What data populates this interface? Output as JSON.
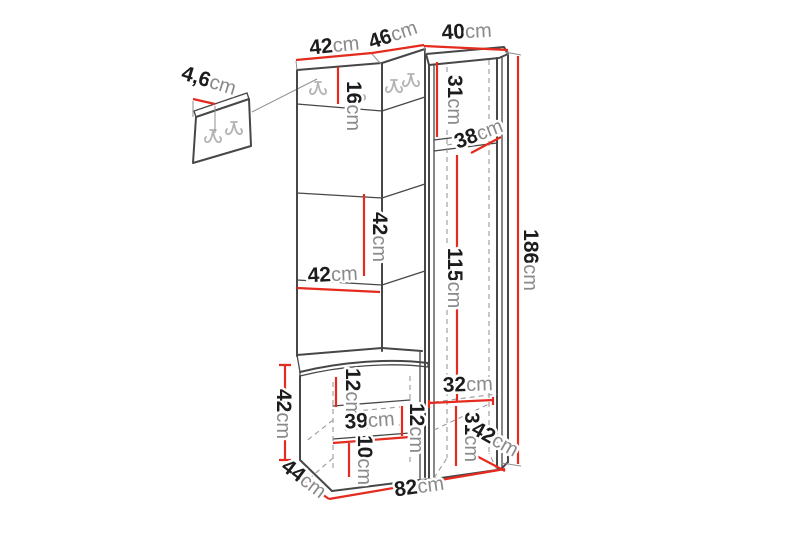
{
  "diagram": {
    "type": "furniture-dimension-drawing",
    "subject": "hallway-corner-wardrobe-set-with-bench-and-hook-panels",
    "unit": "cm",
    "colors": {
      "outline": "#474747",
      "thin": "#8f8f8f",
      "dashed": "#9b9b9b",
      "hook": "#b4b4b4",
      "dimension_line": "#e52a1e",
      "value_text": "#1c1c1c",
      "unit_text": "#8a8a8a",
      "background": "#ffffff"
    },
    "labels": {
      "top_left_width": {
        "value": "42",
        "unit": "cm"
      },
      "corner_width": {
        "value": "46",
        "unit": "cm"
      },
      "right_width": {
        "value": "40",
        "unit": "cm"
      },
      "detail_thickness": {
        "value": "4,6",
        "unit": "cm"
      },
      "hook_strip_height": {
        "value": "16",
        "unit": "cm"
      },
      "right_top_section": {
        "value": "31",
        "unit": "cm"
      },
      "shelf_depth": {
        "value": "38",
        "unit": "cm"
      },
      "right_mid_section": {
        "value": "115",
        "unit": "cm"
      },
      "total_height": {
        "value": "186",
        "unit": "cm"
      },
      "mid_panel_height": {
        "value": "42",
        "unit": "cm"
      },
      "mid_panel_width": {
        "value": "42",
        "unit": "cm"
      },
      "bench_height": {
        "value": "42",
        "unit": "cm"
      },
      "bench_top_offset": {
        "value": "12",
        "unit": "cm"
      },
      "drawer_width": {
        "value": "39",
        "unit": "cm"
      },
      "drawer_height": {
        "value": "12",
        "unit": "cm"
      },
      "bench_bottom_offset": {
        "value": "10",
        "unit": "cm"
      },
      "right_bottom_width": {
        "value": "32",
        "unit": "cm"
      },
      "right_bottom_section": {
        "value": "31",
        "unit": "cm"
      },
      "right_depth": {
        "value": "42",
        "unit": "cm"
      },
      "bench_depth": {
        "value": "44",
        "unit": "cm"
      },
      "total_width": {
        "value": "82",
        "unit": "cm"
      }
    }
  }
}
